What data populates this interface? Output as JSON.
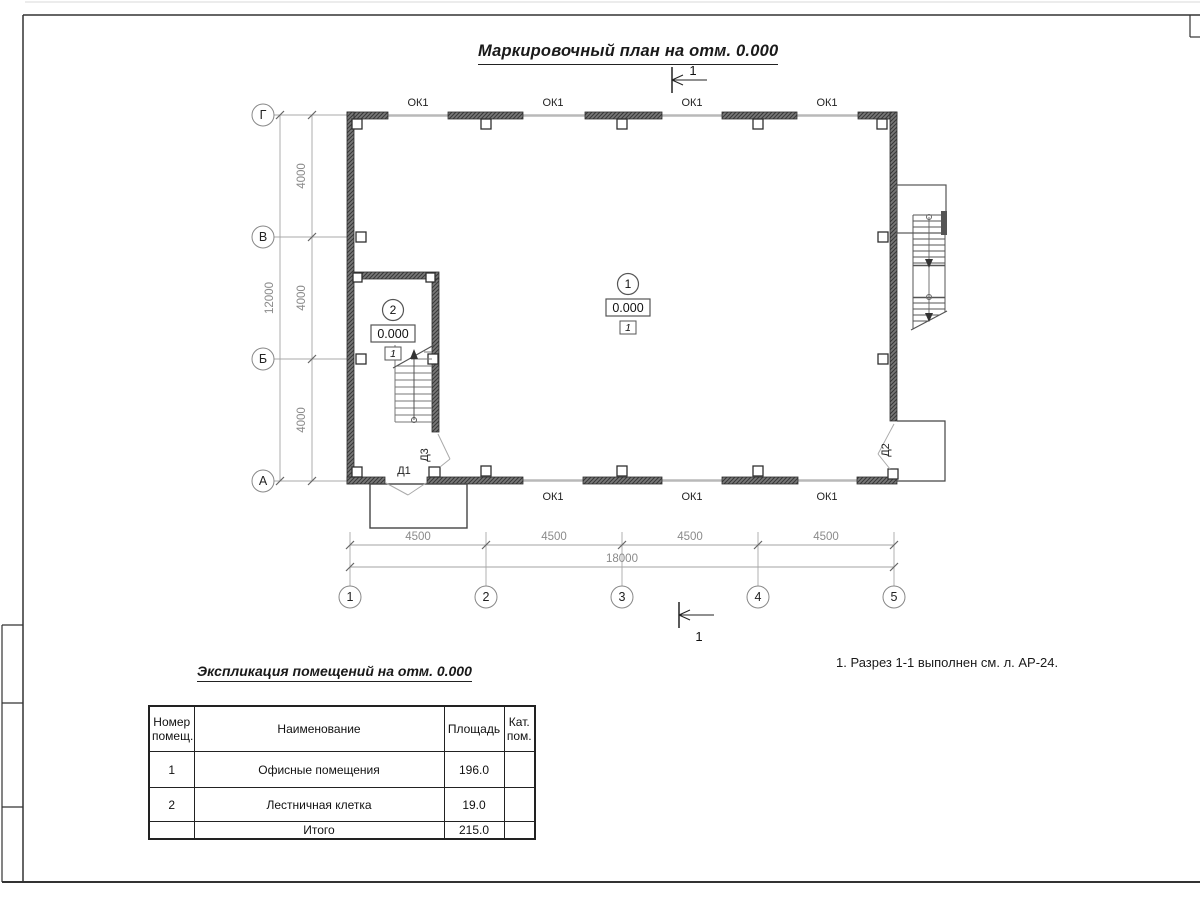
{
  "sheet": {
    "title": "Маркировочный план на отм. 0.000",
    "note": "1. Разрез 1-1 выполнен см. л. АР-24."
  },
  "plan": {
    "section_label": "1",
    "axes_vertical": [
      "Г",
      "В",
      "Б",
      "А"
    ],
    "axes_horizontal": [
      "1",
      "2",
      "3",
      "4",
      "5"
    ],
    "dims_left": [
      "4000",
      "4000",
      "4000"
    ],
    "dim_left_total": "12000",
    "dims_bottom": [
      "4500",
      "4500",
      "4500",
      "4500"
    ],
    "dim_bottom_total": "18000",
    "window_labels_top": [
      "ОК1",
      "ОК1",
      "ОК1",
      "ОК1"
    ],
    "window_labels_bottom": [
      "ОК1",
      "ОК1",
      "ОК1"
    ],
    "doors": {
      "d1": "Д1",
      "d2": "Д2",
      "d3": "Д3"
    },
    "rooms": [
      {
        "number": "1",
        "elevation": "0.000",
        "floor_type": "1"
      },
      {
        "number": "2",
        "elevation": "0.000",
        "floor_type": "1"
      }
    ]
  },
  "table": {
    "caption": "Экспликация помещений на отм. 0.000",
    "headers": [
      "Номер\nпомещ.",
      "Наименование",
      "Площадь",
      "Кат.\nпом."
    ],
    "rows": [
      {
        "num": "1",
        "name": "Офисные помещения",
        "area": "196.0",
        "cat": ""
      },
      {
        "num": "2",
        "name": "Лестничная клетка",
        "area": "19.0",
        "cat": ""
      }
    ],
    "total_label": "Итого",
    "total_value": "215.0"
  },
  "colors": {
    "line": "#2f2f2f",
    "dim": "#8a8a8a",
    "wall": "#555555",
    "window": "#b9b9b9"
  }
}
